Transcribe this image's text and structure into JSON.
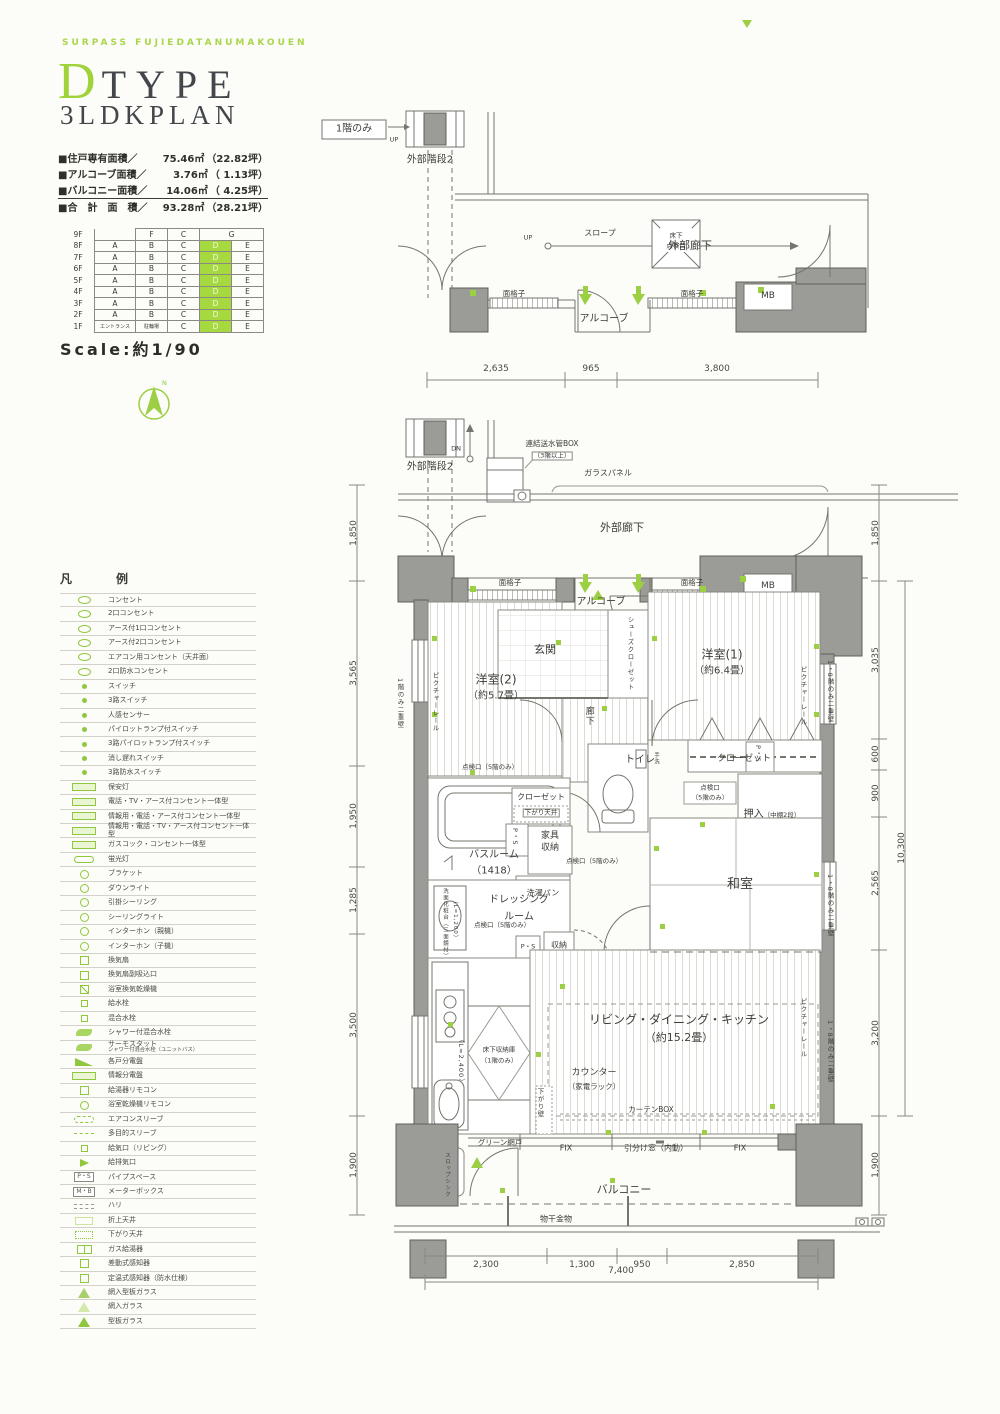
{
  "header": {
    "brand": "SURPASS FUJIEDATANUMAKOUEN",
    "title_letter": "D",
    "title_word": "TYPE",
    "title_sub": "3LDKPLAN",
    "areas": [
      {
        "label": "■住戸専有面積／",
        "value": "75.46㎡",
        "tsubo": "（22.82坪）"
      },
      {
        "label": "■アルコーブ面積／",
        "value": "3.76㎡",
        "tsubo": "（ 1.13坪）"
      },
      {
        "label": "■バルコニー面積／",
        "value": "14.06㎡",
        "tsubo": "（ 4.25坪）"
      },
      {
        "label": "■合　計　面　積／",
        "value": "93.28㎡",
        "tsubo": "（28.21坪）"
      }
    ],
    "scale": "Scale:約1/90"
  },
  "compass": {
    "n": "N"
  },
  "floor_table": {
    "r9": {
      "f": "9F",
      "b": "F",
      "c": "C",
      "g": "G"
    },
    "r8": {
      "f": "8F",
      "a": "A",
      "b": "B",
      "c": "C",
      "d": "D",
      "e": "E"
    },
    "r7": {
      "f": "7F",
      "a": "A",
      "b": "B",
      "c": "C",
      "d": "D",
      "e": "E"
    },
    "r6": {
      "f": "6F",
      "a": "A",
      "b": "B",
      "c": "C",
      "d": "D",
      "e": "E"
    },
    "r5": {
      "f": "5F",
      "a": "A",
      "b": "B",
      "c": "C",
      "d": "D",
      "e": "E"
    },
    "r4": {
      "f": "4F",
      "a": "A",
      "b": "B",
      "c": "C",
      "d": "D",
      "e": "E"
    },
    "r3": {
      "f": "3F",
      "a": "A",
      "b": "B",
      "c": "C",
      "d": "D",
      "e": "E"
    },
    "r2": {
      "f": "2F",
      "a": "A",
      "b": "B",
      "c": "C",
      "d": "D",
      "e": "E"
    },
    "r1": {
      "f": "1F",
      "a": "エントランス",
      "b": "駐輪場",
      "c": "C",
      "d": "D",
      "e": "E"
    }
  },
  "legend": {
    "title": "凡　例",
    "items": [
      {
        "sym": "outlet",
        "label": "コンセント"
      },
      {
        "sym": "outlet",
        "label": "2口コンセント"
      },
      {
        "sym": "outlet",
        "label": "アース付1口コンセント"
      },
      {
        "sym": "outlet",
        "label": "アース付2口コンセント"
      },
      {
        "sym": "outlet",
        "label": "エアコン用コンセント（天井面）"
      },
      {
        "sym": "outlet",
        "label": "2口防水コンセント"
      },
      {
        "sym": "dot",
        "label": "スイッチ"
      },
      {
        "sym": "dot",
        "label": "3路スイッチ"
      },
      {
        "sym": "dot",
        "label": "人感センサー"
      },
      {
        "sym": "dot",
        "label": "パイロットランプ付スイッチ"
      },
      {
        "sym": "dot",
        "label": "3路パイロットランプ付スイッチ"
      },
      {
        "sym": "dot",
        "label": "消し遅れスイッチ"
      },
      {
        "sym": "dot",
        "label": "3路防水スイッチ"
      },
      {
        "sym": "box",
        "label": "保安灯"
      },
      {
        "sym": "box",
        "label": "電話・TV・アース付コンセント一体型"
      },
      {
        "sym": "box",
        "label": "情報用・電話・アース付コンセント一体型"
      },
      {
        "sym": "box",
        "label": "情報用・電話・TV・アース付コンセント一体型"
      },
      {
        "sym": "box",
        "label": "ガスコック・コンセント一体型"
      },
      {
        "sym": "capsule",
        "label": "蛍光灯"
      },
      {
        "sym": "circ",
        "label": "ブラケット"
      },
      {
        "sym": "circ",
        "label": "ダウンライト"
      },
      {
        "sym": "circ",
        "label": "引掛シーリング"
      },
      {
        "sym": "circ",
        "label": "シーリングライト"
      },
      {
        "sym": "circ",
        "label": "インターホン（親機）"
      },
      {
        "sym": "circ",
        "label": "インターホン（子機）"
      },
      {
        "sym": "sq",
        "label": "換気扇"
      },
      {
        "sym": "sq",
        "label": "換気扇副吸込口"
      },
      {
        "sym": "sq-diag",
        "label": "浴室換気乾燥機"
      },
      {
        "sym": "sq-s",
        "label": "給水栓"
      },
      {
        "sym": "sq-s",
        "label": "混合水栓"
      },
      {
        "sym": "wave",
        "label": "シャワー付混合水栓"
      },
      {
        "sym": "wave",
        "label": "サーモスタット",
        "label2": "シャワー付混合水栓（ユニットバス）"
      },
      {
        "sym": "wedge",
        "label": "各戸分電盤"
      },
      {
        "sym": "box",
        "label": "情報分電盤"
      },
      {
        "sym": "sq",
        "label": "給湯器リモコン"
      },
      {
        "sym": "circ",
        "label": "浴室乾燥機リモコン"
      },
      {
        "sym": "capsule-d",
        "label": "エアコンスリーブ"
      },
      {
        "sym": "dash",
        "label": "多目的スリーブ"
      },
      {
        "sym": "sq-s",
        "label": "給気口（リビング）"
      },
      {
        "sym": "arrow",
        "label": "給排気口"
      },
      {
        "sym": "txt",
        "symtext": "P・S",
        "label": "パイプスペース"
      },
      {
        "sym": "txt",
        "symtext": "M・B",
        "label": "メーターボックス"
      },
      {
        "sym": "dash2",
        "label": "ハリ"
      },
      {
        "sym": "box-lt",
        "label": "折上天井"
      },
      {
        "sym": "dots",
        "label": "下がり天井"
      },
      {
        "sym": "sq2",
        "label": "ガス給湯器"
      },
      {
        "sym": "sq",
        "label": "差動式感知器"
      },
      {
        "sym": "sq",
        "label": "定温式感知器（防水仕様）"
      },
      {
        "sym": "tri-d",
        "label": "網入型板ガラス"
      },
      {
        "sym": "tri-o",
        "label": "網入ガラス"
      },
      {
        "sym": "tri-f",
        "label": "型板ガラス"
      }
    ]
  },
  "top_plan": {
    "tag": "1階のみ",
    "stair": "外部階段2",
    "up1": "UP",
    "up2": "UP",
    "slope": "スロープ",
    "corridor": "外部廊下",
    "hatch1": "床下",
    "hatch2": "点検口",
    "alcove": "アルコーブ",
    "grille1": "面格子",
    "grille2": "面格子",
    "mb": "MB",
    "dims": [
      "2,635",
      "965",
      "3,800"
    ]
  },
  "main_plan": {
    "stair": "外部階段2",
    "dn": "DN",
    "standpipe1": "連結送水管BOX",
    "standpipe2": "（3階以上）",
    "glass": "ガラスパネル",
    "corridor": "外部廊下",
    "grille1": "面格子",
    "grille2": "面格子",
    "alcove": "アルコーブ",
    "mb": "MB",
    "genkan": "玄関",
    "shoes": "シューズクローゼット",
    "west2": "洋室(2)",
    "west2_size": "（約5.7畳）",
    "west1": "洋室(1)",
    "west1_size": "（約6.4畳）",
    "rail1": "ピクチャーレール",
    "rail2": "ピクチャーレール",
    "rail3": "ピクチャーレール",
    "wall_l": "1階のみ二重壁",
    "wall_r1": "1・8階のみ二重壁",
    "wall_r2": "1・8階のみ二重壁",
    "wall_r3": "1・8階のみ二重壁",
    "hall": "廊下",
    "insp1": "点検口（5階のみ）",
    "toilet": "トイレ",
    "tearai": "手洗",
    "ps1": "P・S",
    "closet1": "クローゼット",
    "insp2a": "点検口",
    "insp2b": "（5階のみ）",
    "oshiire": "押入",
    "oshiire_note": "（中棚2段）",
    "washitsu": "和室",
    "bath": "バスルーム",
    "bath_size": "（1418）",
    "closet2": "クローゼット",
    "sagari_tenjo": "下がり天井",
    "ps2": "P・S",
    "kagu1": "家具",
    "kagu2": "収納",
    "sentaku": "洗濯パン",
    "insp3": "点検口（5階のみ）",
    "dress1": "ドレッシング",
    "dress2": "ルーム",
    "vanity1": "洗面化粧台（三面鏡付）",
    "vanity2": "（L=1,200）",
    "insp4": "点検口（5階のみ）",
    "ps3": "P・S",
    "shuno": "収納",
    "ldk": "リビング・ダイニング・キッチン",
    "ldk_size": "（約15.2畳）",
    "yukashita1": "床下収納庫",
    "yukashita2": "（1階のみ）",
    "l2400": "（L=2,400）",
    "counter": "カウンター",
    "counter_note": "（家電ラック）",
    "sagari_kabe": "下がり壁",
    "curtain": "カーテンBOX",
    "green_net": "グリーン網戸",
    "slop": "スロップシンク",
    "fix1": "FIX",
    "hikiwake": "引分け窓（内動）",
    "fix2": "FIX",
    "balcony": "バルコニー",
    "monohoshi": "物干金物",
    "dims_left": [
      "1,850",
      "3,565",
      "1,950",
      "1,285",
      "3,500",
      "1,900"
    ],
    "dims_right": [
      "1,850",
      "3,035",
      "600",
      "900",
      "2,565",
      "3,200",
      "1,900"
    ],
    "dim_total_v": "10,300",
    "dims_bottom": [
      "2,300",
      "1,300",
      "950",
      "2,850"
    ],
    "dim_total_h": "7,400"
  }
}
